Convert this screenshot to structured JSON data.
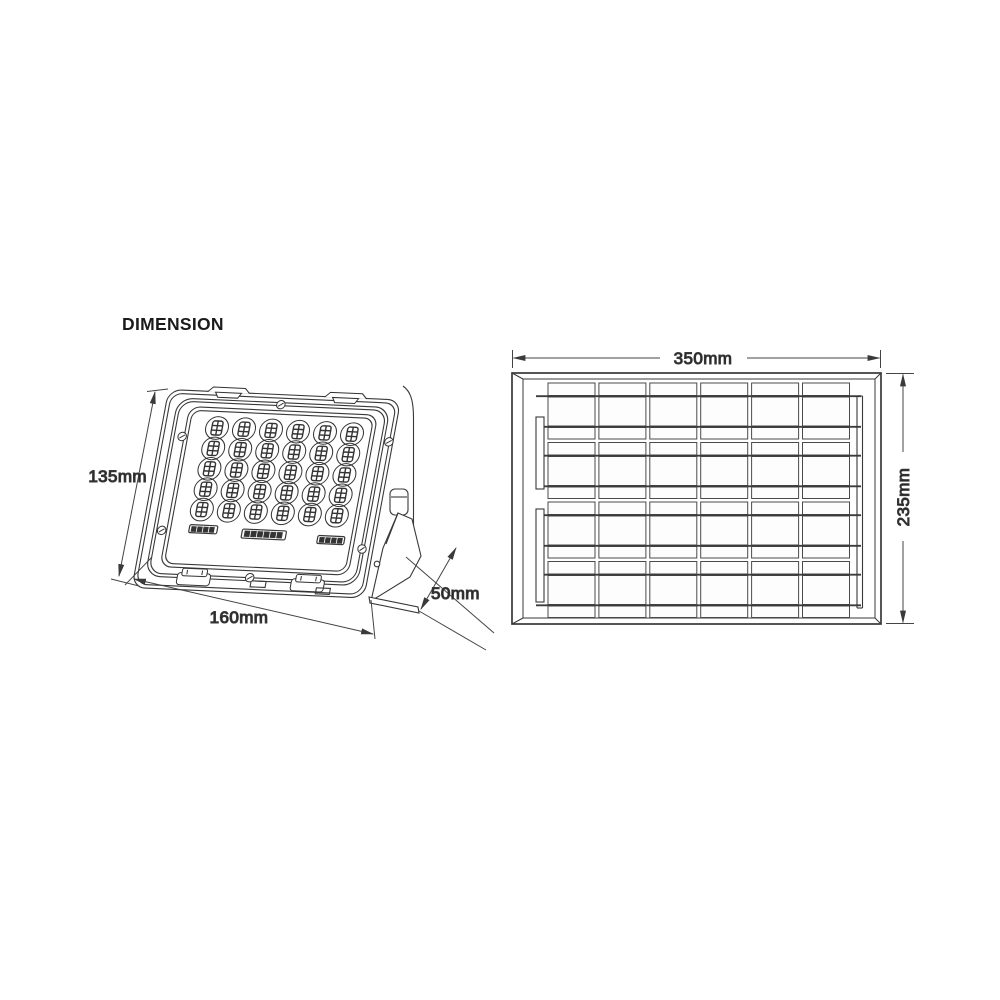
{
  "title": "DIMENSION",
  "colors": {
    "line": "#383838",
    "dim_line": "#444444",
    "text": "#1b1b1b",
    "background": "#ffffff"
  },
  "floodlight": {
    "description": "solar LED flood light, front perspective view with fold-out mounting bracket",
    "labels": {
      "height": "135mm",
      "width": "160mm",
      "bracket_depth": "50mm"
    },
    "led_grid": {
      "columns": 6,
      "rows": 5
    }
  },
  "solar_panel": {
    "description": "solar panel, front view",
    "labels": {
      "width": "350mm",
      "height": "235mm"
    },
    "cell_grid": {
      "columns": 6,
      "cell_rows": 4
    }
  }
}
